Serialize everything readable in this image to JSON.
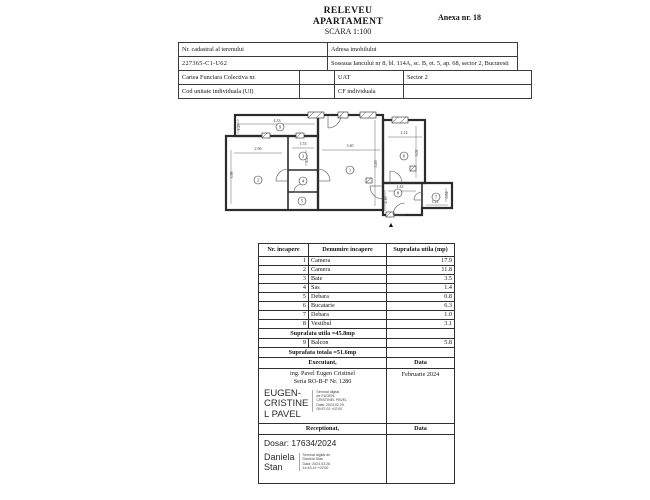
{
  "header": {
    "title1": "RELEVEU",
    "title2": "APARTAMENT",
    "scale": "SCARA 1:100",
    "annex": "Anexa nr. 18"
  },
  "info": {
    "nr_cadastral_label": "Nr. cadastral al terenului",
    "nr_cadastral_value": "227365-C1-U62",
    "adresa_label": "Adresa imobilului",
    "adresa_value": "Soseaua Iancului nr 8, bl. 114A, sc. B, et. 5, ap. 68, sector 2, Bucuresti",
    "carte_funciara_label": "Cartea Funciara Colectiva nr.",
    "uat_label": "UAT",
    "uat_value": "Sector 2",
    "cod_ui_label": "Cod unitate individuala (UI)",
    "cf_label": "CF individuala"
  },
  "floorplan": {
    "entrance_arrow": "▲",
    "rooms": [
      {
        "n": "1",
        "x": 130,
        "y": 62
      },
      {
        "n": "2",
        "x": 38,
        "y": 72
      },
      {
        "n": "3",
        "x": 83,
        "y": 48
      },
      {
        "n": "4",
        "x": 83,
        "y": 73
      },
      {
        "n": "5",
        "x": 82,
        "y": 93
      },
      {
        "n": "6",
        "x": 184,
        "y": 48
      },
      {
        "n": "7",
        "x": 216,
        "y": 89
      },
      {
        "n": "8",
        "x": 178,
        "y": 85
      },
      {
        "n": "9",
        "x": 60,
        "y": 19
      }
    ],
    "dims": [
      {
        "t": "4.33",
        "x": 57,
        "y": 14,
        "r": 0
      },
      {
        "t": "1.29",
        "x": 20,
        "y": 19,
        "r": 1
      },
      {
        "t": "2.96",
        "x": 38,
        "y": 42,
        "r": 0
      },
      {
        "t": "3.98",
        "x": 13,
        "y": 67,
        "r": 1
      },
      {
        "t": "1.53",
        "x": 83,
        "y": 37,
        "r": 0
      },
      {
        "t": "2.29",
        "x": 88,
        "y": 51,
        "r": 1
      },
      {
        "t": "3.40",
        "x": 130,
        "y": 39,
        "r": 0
      },
      {
        "t": "5.26",
        "x": 157,
        "y": 56,
        "r": 1
      },
      {
        "t": "2.14",
        "x": 184,
        "y": 26,
        "r": 0
      },
      {
        "t": "3.02",
        "x": 198,
        "y": 45,
        "r": 1
      },
      {
        "t": "1.43",
        "x": 180,
        "y": 80,
        "r": 0
      },
      {
        "t": "2.16",
        "x": 167,
        "y": 92,
        "r": 1
      },
      {
        "t": "1.24",
        "x": 215,
        "y": 95,
        "r": 0
      },
      {
        "t": "0.84",
        "x": 228,
        "y": 87,
        "r": 1
      }
    ]
  },
  "room_table": {
    "headers": [
      "Nr. incapere",
      "Denumire incapere",
      "Suprafata utila (mp)"
    ],
    "rows": [
      {
        "nr": "1",
        "name": "Camera",
        "area": "17.9"
      },
      {
        "nr": "2",
        "name": "Camera",
        "area": "11.8"
      },
      {
        "nr": "3",
        "name": "Baie",
        "area": "3.5"
      },
      {
        "nr": "4",
        "name": "Sas",
        "area": "1.4"
      },
      {
        "nr": "5",
        "name": "Debara",
        "area": "0.8"
      },
      {
        "nr": "6",
        "name": "Bucatarie",
        "area": "6.3"
      },
      {
        "nr": "7",
        "name": "Debara",
        "area": "1.0"
      },
      {
        "nr": "8",
        "name": "Vestibul",
        "area": "3.1"
      }
    ],
    "subtotal": "Suprafata utila =45.8mp",
    "balcony_row": {
      "nr": "9",
      "name": "Balcon",
      "area": "5.8"
    },
    "total": "Suprafata totala =51.6mp"
  },
  "executant": {
    "label": "Executant,",
    "data_label": "Data",
    "name_line1": "ing. Pavel Eugen Cristinel",
    "name_line2": "Seria RO-B-F Nr. 1280",
    "date": "Februarie 2024",
    "signature_name": "EUGEN-\nCRISTINE\nL PAVEL",
    "signature_detail": "Semnat digital\nde EUGEN-\nCRISTINEL PAVEL\nData: 2024.02.29\n09:57:01 +02'00'"
  },
  "receptionat": {
    "label": "Receptionat,",
    "data_label": "Data",
    "dosar": "Dosar: 17634/2024",
    "signature_name": "Daniela\nStan",
    "signature_detail": "Semnat digital de\nDaniela Stan\nData: 2024.03.26\n14:43:19 +02'00'"
  }
}
